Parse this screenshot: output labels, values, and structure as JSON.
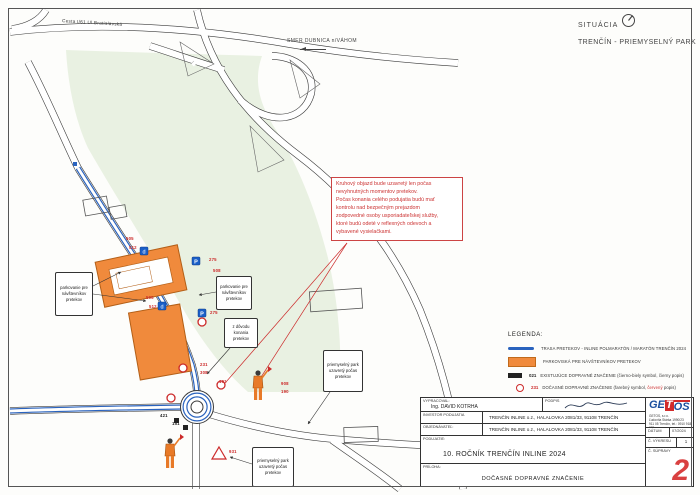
{
  "colors": {
    "route_blue": "#2a63be",
    "parking_orange": "#f08a3c",
    "temporary_red": "#cc2a2a"
  },
  "header": {
    "situacia_label": "SITUÁCIA",
    "park_title": "TRENČÍN - PRIEMYSELNÝ PARK"
  },
  "map": {
    "road_label": "Cesta I/61 Ul.Bratislavská",
    "direction_label": "SMER DUBNICA n/VÁHOM",
    "note_text": "Kruhový objazd bude uzavretý len počas\nnevyhnutných momentov pretekov.\nPočas konania celého podujatia budú mať\nkontrolu nad bezpečným prejazdom\nzodpovedné osoby usporiadateľskej služby,\nktoré budú odeté v reflexných odevoch a\nvybavené vysielačkami.",
    "callouts": [
      {
        "text": "parkovanie pre návštevníkov pretekov",
        "x": 55,
        "y": 272,
        "w": 38,
        "h": 44
      },
      {
        "text": "parkovanie pre návštevníkov pretekov",
        "x": 216,
        "y": 276,
        "w": 36,
        "h": 34
      },
      {
        "text": "z dôvodu konania pretekov",
        "x": 224,
        "y": 318,
        "w": 34,
        "h": 30
      },
      {
        "text": "priemyselný park uzavretý počas pretekov",
        "x": 323,
        "y": 350,
        "w": 40,
        "h": 42
      },
      {
        "text": "priemyselný park uzavretý počas pretekov",
        "x": 252,
        "y": 447,
        "w": 42,
        "h": 40
      }
    ],
    "sign_labels": [
      {
        "text": "505",
        "x": 126,
        "y": 236,
        "color": "#cc2a2a"
      },
      {
        "text": "512",
        "x": 129,
        "y": 245,
        "color": "#cc2a2a"
      },
      {
        "text": "275",
        "x": 209,
        "y": 257,
        "color": "#cc2a2a"
      },
      {
        "text": "508",
        "x": 213,
        "y": 268,
        "color": "#cc2a2a"
      },
      {
        "text": "505",
        "x": 146,
        "y": 295,
        "color": "#cc2a2a"
      },
      {
        "text": "512",
        "x": 149,
        "y": 304,
        "color": "#cc2a2a"
      },
      {
        "text": "275",
        "x": 210,
        "y": 310,
        "color": "#cc2a2a"
      },
      {
        "text": "231",
        "x": 200,
        "y": 362,
        "color": "#cc2a2a"
      },
      {
        "text": "308",
        "x": 200,
        "y": 370,
        "color": "#cc2a2a"
      },
      {
        "text": "101",
        "x": 219,
        "y": 379,
        "color": "#cc2a2a"
      },
      {
        "text": "908",
        "x": 281,
        "y": 381,
        "color": "#cc2a2a"
      },
      {
        "text": "190",
        "x": 281,
        "y": 389,
        "color": "#cc2a2a"
      },
      {
        "text": "421",
        "x": 160,
        "y": 413,
        "color": "#222222"
      },
      {
        "text": "151",
        "x": 172,
        "y": 421,
        "color": "#222222"
      },
      {
        "text": "931",
        "x": 229,
        "y": 449,
        "color": "#cc2a2a"
      }
    ]
  },
  "legend": {
    "title": "LEGENDA:",
    "items": [
      {
        "icon": "route-line",
        "label": "TRASA PRETEKOV - INLINE POLMARATÓN / MARATÓN TRENČÍN 2024"
      },
      {
        "icon": "parking-area",
        "label": "PARKOVISKÁ PRE NÁVŠTEVNÍKOV PRETEKOV"
      },
      {
        "icon": "sign-existing",
        "code": "021",
        "label": "EXISTUJÚCE DOPRAVNÉ ZNAČENIE (čierno-biely symbol, čierny popis)"
      },
      {
        "icon": "sign-temporary",
        "code": "231",
        "label_prefix": "DOČASNÉ DOPRAVNÉ ZNAČENIE (farebný symbol, ",
        "label_red": "červený",
        "label_suffix": " popis)"
      }
    ]
  },
  "title_block": {
    "vypracoval_label": "VYPRACOVAL:",
    "vypracoval_value": "Ing. DAVID KOTRHA",
    "podpis_label": "PODPIS",
    "investor_label": "INVESTOR PODUJATIA",
    "investor_value": "TRENČÍN INLINE o.z., HALALOVKA 2081/33, 91108 TRENČÍN",
    "objednavatel_label": "OBJEDNÁVATEĽ:",
    "objednavatel_value": "TRENČÍN INLINE o.z., HALALOVKA 2081/33, 91108 TRENČÍN",
    "podujatie_label": "PODUJATIE:",
    "podujatie_value": "10. ROČNÍK TRENČÍN INLINE 2024",
    "priloha_label": "PRÍLOHA:",
    "priloha_value": "DOČASNÉ DOPRAVNÉ ZNAČENIE",
    "datum_label": "DÁTUM",
    "datum_value": "07/2024",
    "vykres_label": "Č. VÝKRESU",
    "vykres_value": "1",
    "suprava_label": "Č. SÚPRAVY",
    "suprava_value": "2",
    "company": {
      "name_ge": "GE",
      "name_t": "T",
      "name_os": "OS",
      "line1": "GETOS, s.r.o.",
      "line2": "Ľudovíta Stárka 1990/23",
      "line3": "911 05 Trenčín, tel.: 0910 918 235"
    }
  }
}
